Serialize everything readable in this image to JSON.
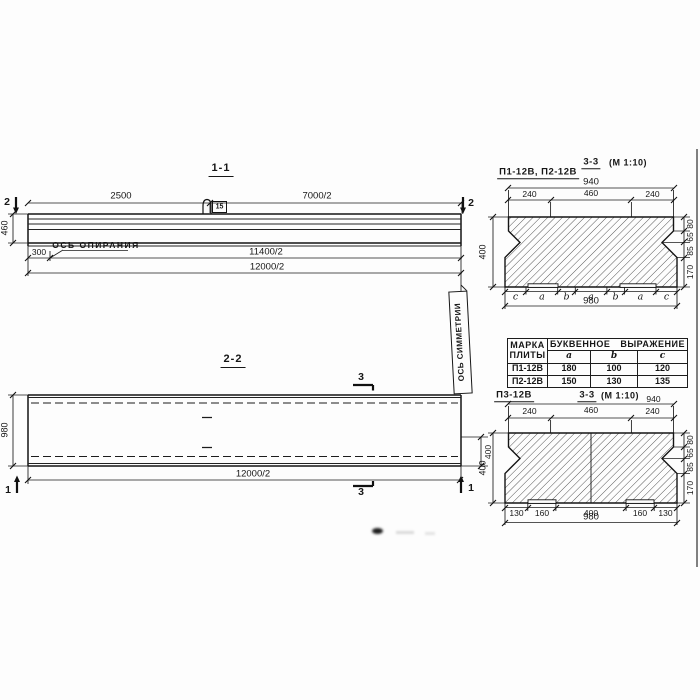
{
  "s11": {
    "title": "1-1",
    "dim2500": "2500",
    "dim7000": "7000/2",
    "cut_left": "2",
    "cut_right": "2",
    "height": "460",
    "dim300": "300",
    "bearing_axis": "ОСЬ ОПИРАНИЯ",
    "dim11400": "11400/2",
    "dim12000": "12000/2",
    "loop_tag": "15"
  },
  "s22": {
    "title": "2-2",
    "cut3_top": "3",
    "cut3_bottom": "3",
    "cut1_left": "1",
    "cut1_right": "1",
    "width": "980",
    "dim12000": "12000/2",
    "dim400": "400",
    "symmetry_axis": "ОСЬ СИММЕТРИИ"
  },
  "secTop": {
    "label": "П1-12В, П2-12В",
    "title": "3-3",
    "scale": "(М 1:10)",
    "dim940": "940",
    "dimsTop": [
      "240",
      "460",
      "240"
    ],
    "dim400": "400",
    "dimsRight": [
      "80",
      "65",
      "85",
      "170"
    ],
    "letters": [
      "c",
      "a",
      "b",
      "a",
      "b",
      "a",
      "c"
    ],
    "dim980": "980"
  },
  "table": {
    "header_col1_line1": "МАРКА",
    "header_col1_line2": "ПЛИТЫ",
    "header_expr": "БУКВЕННОЕ ВЫРАЖЕНИЕ",
    "cols": [
      "a",
      "b",
      "c"
    ],
    "rows": [
      [
        "П1-12В",
        "180",
        "100",
        "120"
      ],
      [
        "П2-12В",
        "150",
        "130",
        "135"
      ]
    ]
  },
  "secBot": {
    "label": "П3-12В",
    "title": "3-3",
    "scale": "(М 1:10)",
    "dim940": "940",
    "dimsTop": [
      "240",
      "460",
      "240"
    ],
    "dim400": "400",
    "dimsRight": [
      "80",
      "65",
      "85",
      "170"
    ],
    "dimsBottom": [
      "130",
      "160",
      "400",
      "160",
      "130"
    ],
    "dim980": "980"
  }
}
